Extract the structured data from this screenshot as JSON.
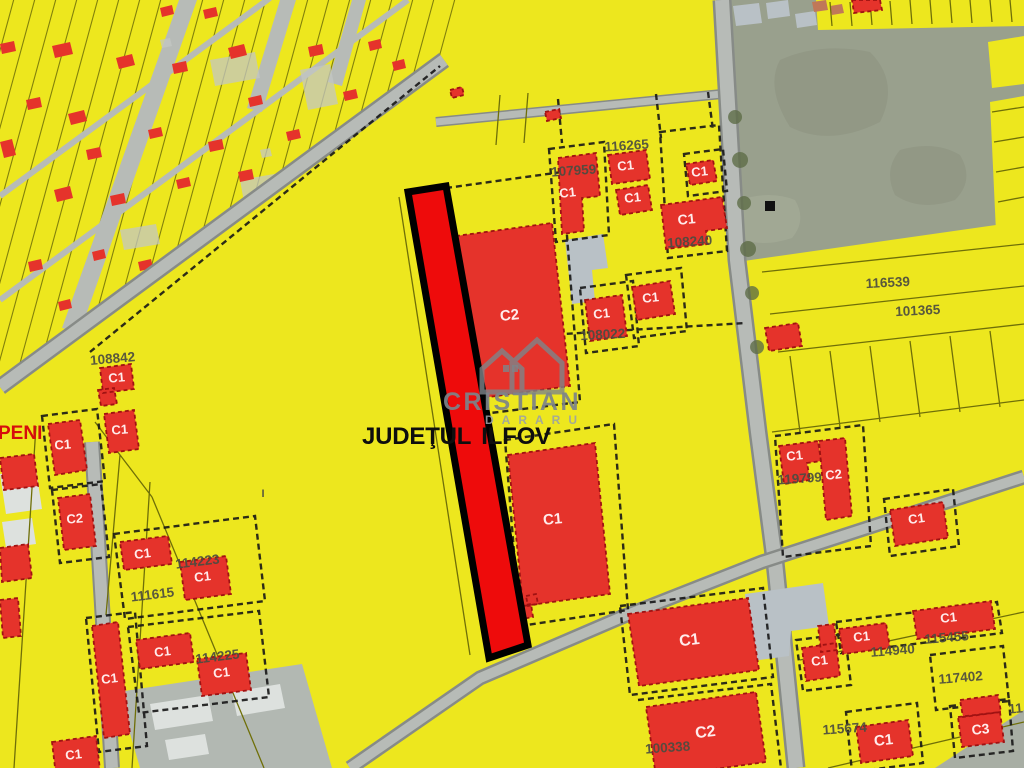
{
  "map": {
    "region_text": "JUDEŢUL ILFOV",
    "partial_place_label": "PENI",
    "watermark": {
      "icon": "houses-icon",
      "brand_top": "CRISTIAN",
      "brand_bottom": "DARARU"
    },
    "parcel_numbers": [
      {
        "t": "116265",
        "x": 627,
        "y": 150,
        "r": -4
      },
      {
        "t": "107959",
        "x": 574,
        "y": 175,
        "r": -4
      },
      {
        "t": "108240",
        "x": 690,
        "y": 246,
        "r": -4
      },
      {
        "t": "108022",
        "x": 603,
        "y": 339,
        "r": -3
      },
      {
        "t": "116539",
        "x": 888,
        "y": 287,
        "r": -3
      },
      {
        "t": "101365",
        "x": 918,
        "y": 315,
        "r": -3
      },
      {
        "t": "108842",
        "x": 113,
        "y": 363,
        "r": -5
      },
      {
        "t": "119799",
        "x": 800,
        "y": 483,
        "r": -4
      },
      {
        "t": "114223",
        "x": 198,
        "y": 566,
        "r": -7
      },
      {
        "t": "111615",
        "x": 153,
        "y": 599,
        "r": -7
      },
      {
        "t": "114225",
        "x": 218,
        "y": 661,
        "r": -7
      },
      {
        "t": "115455",
        "x": 947,
        "y": 642,
        "r": -5
      },
      {
        "t": "114940",
        "x": 893,
        "y": 655,
        "r": -5
      },
      {
        "t": "117402",
        "x": 961,
        "y": 682,
        "r": -5
      },
      {
        "t": "115674",
        "x": 845,
        "y": 733,
        "r": -4
      },
      {
        "t": "100338",
        "x": 668,
        "y": 752,
        "r": -4
      },
      {
        "t": "11",
        "x": 1016,
        "y": 713,
        "r": -5
      },
      {
        "t": "I",
        "x": 263,
        "y": 497,
        "r": 0,
        "s": 11
      }
    ],
    "building_labels": [
      {
        "t": "C1",
        "x": 568,
        "y": 197,
        "r": -6
      },
      {
        "t": "C1",
        "x": 626,
        "y": 170,
        "r": -6
      },
      {
        "t": "C1",
        "x": 633,
        "y": 202,
        "r": -6
      },
      {
        "t": "C1",
        "x": 700,
        "y": 176,
        "r": -6
      },
      {
        "t": "C1",
        "x": 687,
        "y": 224,
        "r": -6,
        "s": 14
      },
      {
        "t": "C2",
        "x": 510,
        "y": 320,
        "r": -6,
        "s": 15
      },
      {
        "t": "C1",
        "x": 602,
        "y": 318,
        "r": -6
      },
      {
        "t": "C1",
        "x": 651,
        "y": 302,
        "r": -6
      },
      {
        "t": "C1",
        "x": 553,
        "y": 524,
        "r": -5,
        "s": 15
      },
      {
        "t": "C1",
        "x": 795,
        "y": 460,
        "r": -6
      },
      {
        "t": "C2",
        "x": 834,
        "y": 479,
        "r": -6
      },
      {
        "t": "C1",
        "x": 917,
        "y": 523,
        "r": -8
      },
      {
        "t": "C1",
        "x": 63,
        "y": 449,
        "r": -4
      },
      {
        "t": "C1",
        "x": 120,
        "y": 434,
        "r": -4
      },
      {
        "t": "C2",
        "x": 75,
        "y": 523,
        "r": -4
      },
      {
        "t": "C1",
        "x": 143,
        "y": 558,
        "r": -7
      },
      {
        "t": "C1",
        "x": 203,
        "y": 581,
        "r": -7
      },
      {
        "t": "C1",
        "x": 163,
        "y": 656,
        "r": -7
      },
      {
        "t": "C1",
        "x": 222,
        "y": 677,
        "r": -7
      },
      {
        "t": "C1",
        "x": 110,
        "y": 683,
        "r": -7
      },
      {
        "t": "C1",
        "x": 74,
        "y": 759,
        "r": -6
      },
      {
        "t": "C1",
        "x": 949,
        "y": 622,
        "r": -6
      },
      {
        "t": "C1",
        "x": 862,
        "y": 641,
        "r": -6
      },
      {
        "t": "C1",
        "x": 884,
        "y": 745,
        "r": -6,
        "s": 15
      },
      {
        "t": "C3",
        "x": 981,
        "y": 734,
        "r": -6,
        "s": 14
      },
      {
        "t": "C1",
        "x": 690,
        "y": 645,
        "r": -7,
        "s": 16
      },
      {
        "t": "C2",
        "x": 706,
        "y": 737,
        "r": -7,
        "s": 16
      },
      {
        "t": "C1",
        "x": 820,
        "y": 665,
        "r": -7
      },
      {
        "t": "C1",
        "x": 117,
        "y": 382,
        "r": -5
      }
    ]
  },
  "colors": {
    "parcel_yellow": "#EDE71E",
    "parcel_line": "#6F6F08",
    "zone_dash": "#161616",
    "building_red": "#E5332B",
    "building_edge": "#A01212",
    "highlight_red": "#EE0B0B",
    "highlight_outline": "#000000",
    "road_gray": "#B7BBB7",
    "road_edge": "#878B87",
    "field_gray_green": "#99A08D",
    "gray_building": "#B9C1C6",
    "number_text": "#4C4C40",
    "class_text": "#FFECEC",
    "peni_text": "#D60D0D",
    "watermark_gray": "#7D848A",
    "region_text_color": "#0E0E0E"
  }
}
